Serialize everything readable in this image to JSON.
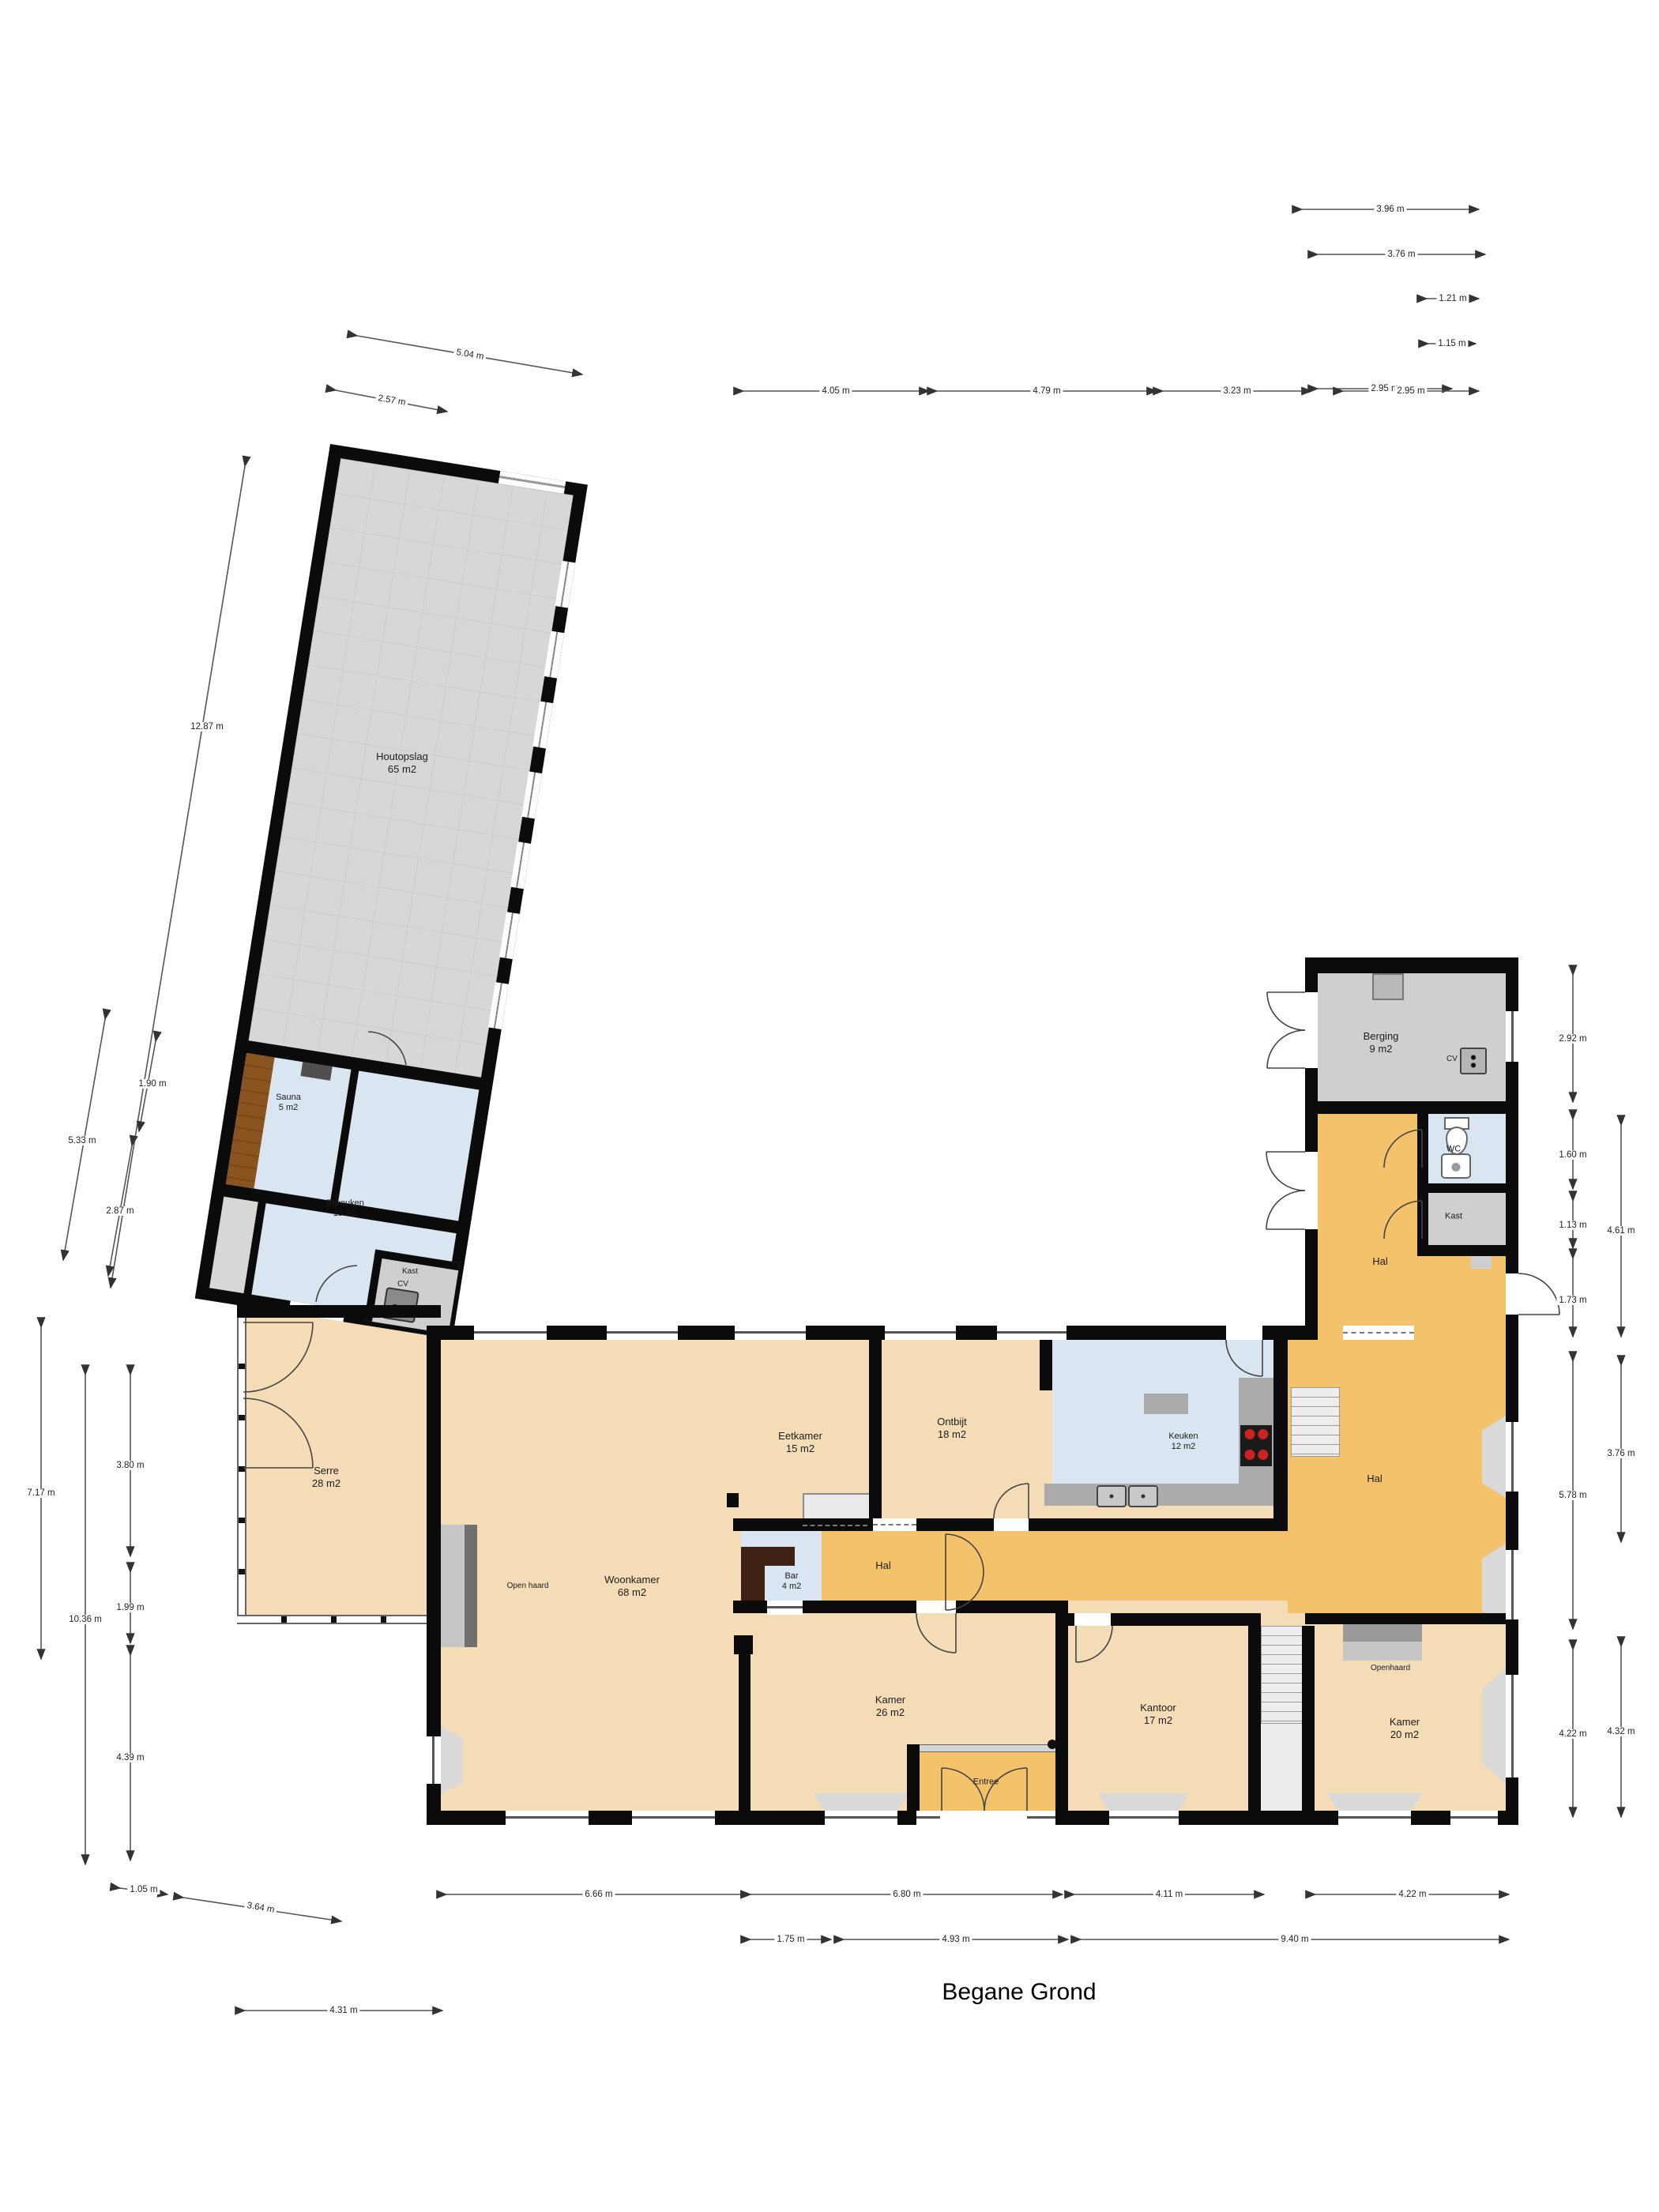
{
  "title": "Begane Grond",
  "rooms": [
    {
      "name": "Houtopslag",
      "area": "65 m2"
    },
    {
      "name": "Sauna",
      "area": "5 m2"
    },
    {
      "name": "Bijkeuken",
      "area": "15 m2"
    },
    {
      "name": "Kast"
    },
    {
      "name": "Berging",
      "area": "9 m2"
    },
    {
      "name": "WC"
    },
    {
      "name": "Kast"
    },
    {
      "name": "Hal"
    },
    {
      "name": "Serre",
      "area": "28 m2"
    },
    {
      "name": "Eetkamer",
      "area": "15 m2"
    },
    {
      "name": "Ontbijt",
      "area": "18 m2"
    },
    {
      "name": "Keuken",
      "area": "12 m2"
    },
    {
      "name": "Hal"
    },
    {
      "name": "Woonkamer",
      "area": "68 m2"
    },
    {
      "name": "Bar",
      "area": "4 m2"
    },
    {
      "name": "Hal"
    },
    {
      "name": "Kamer",
      "area": "26 m2"
    },
    {
      "name": "Kantoor",
      "area": "17 m2"
    },
    {
      "name": "Kamer",
      "area": "20 m2"
    },
    {
      "name": "Entree"
    }
  ],
  "fixtures": {
    "cv": "CV",
    "open_haard": "Open haard",
    "openhaard": "Openhaard"
  },
  "dims": [
    "3.96 m",
    "3.76 m",
    "1.21 m",
    "1.15 m",
    "2.95 m",
    "5.04 m",
    "2.57 m",
    "4.05 m",
    "4.79 m",
    "3.23 m",
    "2.95 m",
    "12.87 m",
    "1.90 m",
    "5.33 m",
    "2.87 m",
    "7.17 m",
    "10.36 m",
    "3.80 m",
    "1.99 m",
    "4.39 m",
    "1.05 m",
    "3.64 m",
    "4.31 m",
    "6.66 m",
    "6.80 m",
    "4.11 m",
    "4.22 m",
    "1.75 m",
    "4.93 m",
    "9.40 m",
    "2.92 m",
    "1.60 m",
    "1.13 m",
    "1.73 m",
    "5.78 m",
    "4.22 m",
    "4.61 m",
    "3.76 m",
    "4.32 m"
  ],
  "colors": {
    "wall": "#0b0b0b",
    "room_tan": "#f4ddb6",
    "hall_orange": "#f5c26c",
    "room_blue": "#d9e6f2",
    "storage_gray": "#d7d7d7",
    "counter_gray": "#ababab",
    "bar_wood": "#3f2114",
    "sauna_wood": "#8a5420",
    "burner_red": "#cc2222"
  }
}
